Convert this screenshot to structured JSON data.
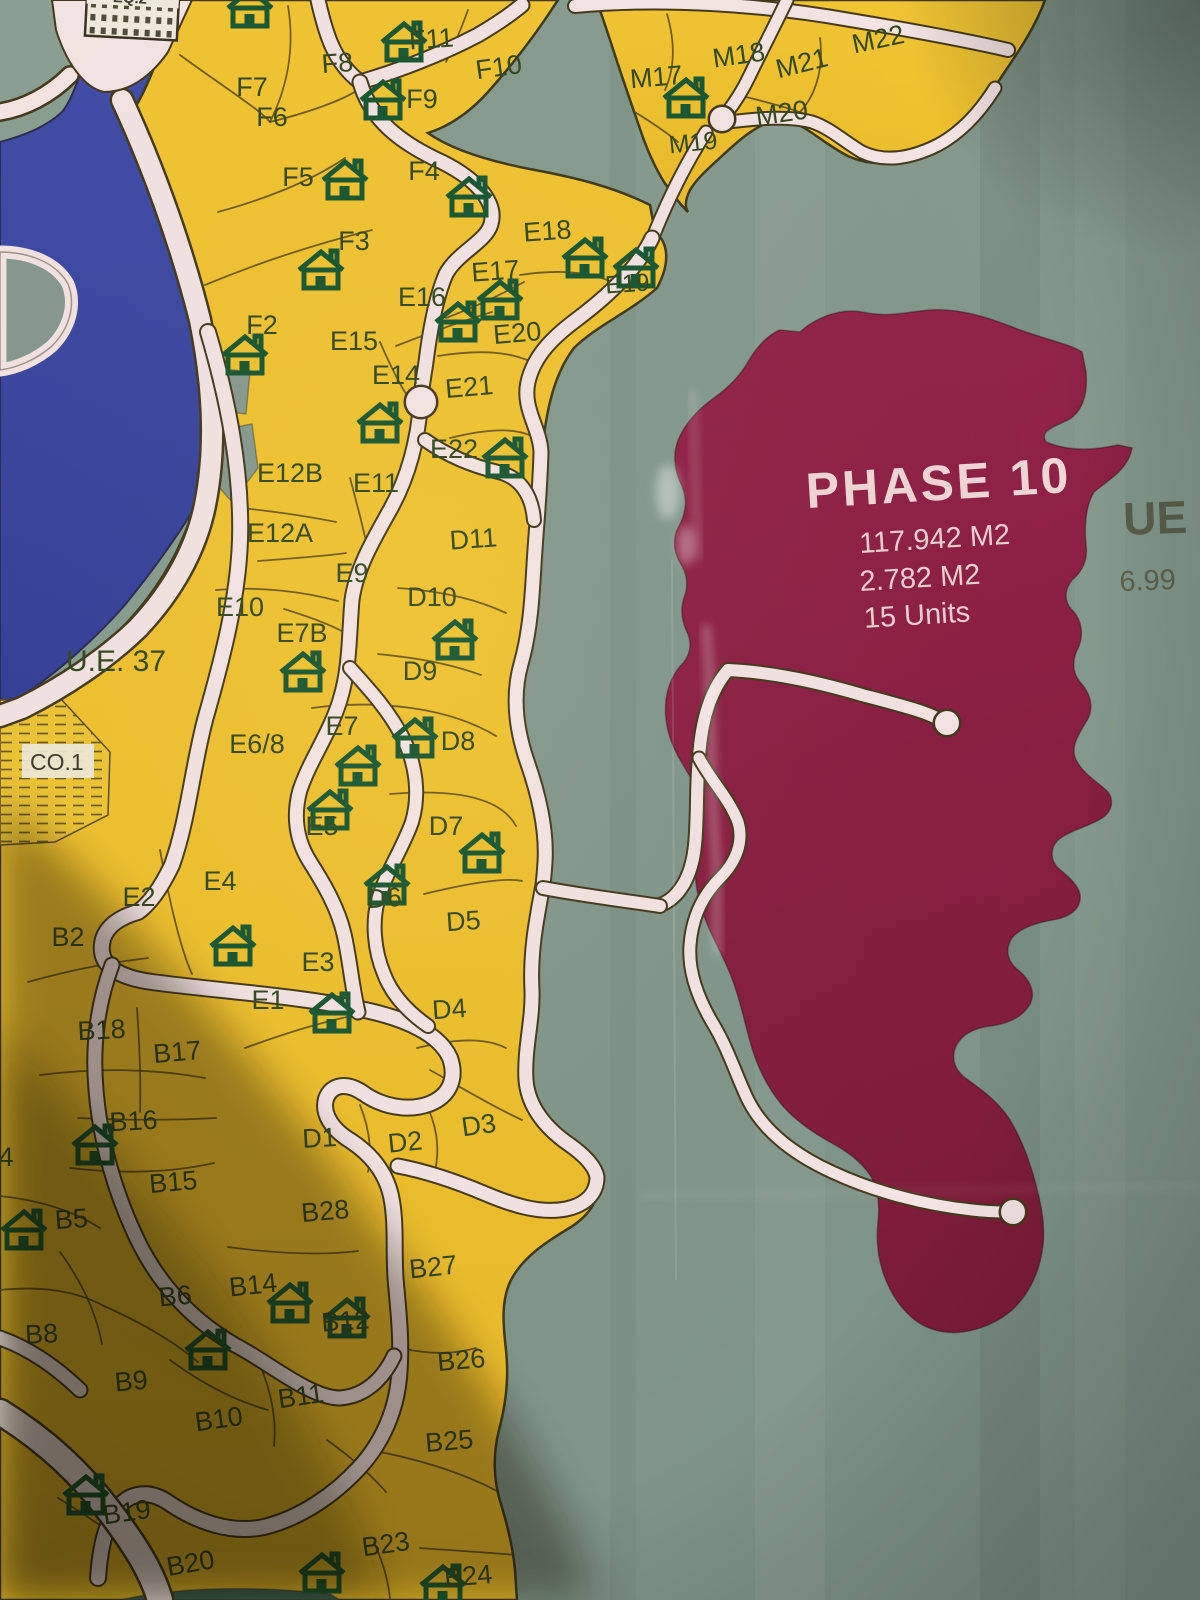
{
  "map": {
    "phase10": {
      "name": "PHASE 10",
      "area1": "117.942 M2",
      "area2": "2.782 M2",
      "units": "15 Units"
    },
    "edge": {
      "ue": "UE",
      "ue_value": "6.99"
    },
    "special": {
      "co1": "CO.1",
      "eq2": "EQ.2"
    },
    "colors": {
      "parcel_yellow": "#efc02e",
      "phase_maroon": "#8c2043",
      "water_blue": "#3c48a0",
      "road_pink": "#f3e3e2",
      "background_teal": "#87998e",
      "label_green": "#33491f",
      "house_green": "#1a5732",
      "phase_text": "#efd5d6"
    },
    "parcels": [
      {
        "id": "F7",
        "x": 252,
        "y": 96
      },
      {
        "id": "F8",
        "x": 338,
        "y": 72,
        "r": -4
      },
      {
        "id": "F11",
        "x": 432,
        "y": 48,
        "r": -4
      },
      {
        "id": "F10",
        "x": 500,
        "y": 76,
        "r": -8
      },
      {
        "id": "M17",
        "x": 657,
        "y": 86,
        "r": -5
      },
      {
        "id": "M18",
        "x": 740,
        "y": 64,
        "r": -8
      },
      {
        "id": "M19",
        "x": 694,
        "y": 151,
        "r": -6,
        "s": 25
      },
      {
        "id": "M20",
        "x": 783,
        "y": 122,
        "r": -8
      },
      {
        "id": "M21",
        "x": 804,
        "y": 72,
        "r": -14
      },
      {
        "id": "M22",
        "x": 880,
        "y": 48,
        "r": -12
      },
      {
        "id": "F6",
        "x": 272,
        "y": 126
      },
      {
        "id": "F9",
        "x": 422,
        "y": 108
      },
      {
        "id": "F5",
        "x": 298,
        "y": 186
      },
      {
        "id": "F4",
        "x": 424,
        "y": 180
      },
      {
        "id": "F3",
        "x": 354,
        "y": 250
      },
      {
        "id": "E18",
        "x": 548,
        "y": 240,
        "r": -4
      },
      {
        "id": "E17",
        "x": 496,
        "y": 280,
        "r": -4
      },
      {
        "id": "E19",
        "x": 628,
        "y": 292,
        "r": -4,
        "s": 25
      },
      {
        "id": "E16",
        "x": 422,
        "y": 306
      },
      {
        "id": "E20",
        "x": 518,
        "y": 342,
        "r": -5
      },
      {
        "id": "F2",
        "x": 262,
        "y": 334
      },
      {
        "id": "E15",
        "x": 354,
        "y": 350
      },
      {
        "id": "E14",
        "x": 396,
        "y": 384
      },
      {
        "id": "E21",
        "x": 470,
        "y": 396,
        "r": -5
      },
      {
        "id": "E22",
        "x": 454,
        "y": 458
      },
      {
        "id": "E12B",
        "x": 290,
        "y": 482
      },
      {
        "id": "E11",
        "x": 376,
        "y": 492
      },
      {
        "id": "D11",
        "x": 474,
        "y": 548,
        "r": -4
      },
      {
        "id": "E12A",
        "x": 280,
        "y": 542
      },
      {
        "id": "E9",
        "x": 352,
        "y": 582
      },
      {
        "id": "D10",
        "x": 432,
        "y": 606
      },
      {
        "id": "E10",
        "x": 240,
        "y": 616
      },
      {
        "id": "E7B",
        "x": 302,
        "y": 642
      },
      {
        "id": "D9",
        "x": 420,
        "y": 680
      },
      {
        "id": "U.E. 37",
        "x": 116,
        "y": 671,
        "s": 30
      },
      {
        "id": "E7",
        "x": 342,
        "y": 735
      },
      {
        "id": "E6/8",
        "x": 257,
        "y": 753
      },
      {
        "id": "D8",
        "x": 458,
        "y": 750
      },
      {
        "id": "E5",
        "x": 322,
        "y": 835
      },
      {
        "id": "D7",
        "x": 446,
        "y": 835
      },
      {
        "id": "E4",
        "x": 220,
        "y": 890
      },
      {
        "id": "E2",
        "x": 139,
        "y": 906
      },
      {
        "id": "D6",
        "x": 385,
        "y": 907,
        "r": -4
      },
      {
        "id": "B2",
        "x": 68,
        "y": 946
      },
      {
        "id": "D5",
        "x": 464,
        "y": 930,
        "r": -4
      },
      {
        "id": "E3",
        "x": 318,
        "y": 971
      },
      {
        "id": "E1",
        "x": 268,
        "y": 1009
      },
      {
        "id": "D4",
        "x": 450,
        "y": 1018,
        "r": -4
      },
      {
        "id": "B18",
        "x": 102,
        "y": 1039,
        "r": -3
      },
      {
        "id": "B17",
        "x": 178,
        "y": 1061,
        "r": -5
      },
      {
        "id": "B16",
        "x": 134,
        "y": 1130,
        "r": -3
      },
      {
        "id": "D1",
        "x": 320,
        "y": 1147,
        "r": -3
      },
      {
        "id": "D2",
        "x": 406,
        "y": 1151,
        "r": -6
      },
      {
        "id": "D3",
        "x": 480,
        "y": 1134,
        "r": -8
      },
      {
        "id": "B15",
        "x": 174,
        "y": 1191,
        "r": -5
      },
      {
        "id": "B5",
        "x": 72,
        "y": 1228,
        "r": -4
      },
      {
        "id": "B28",
        "x": 326,
        "y": 1220,
        "r": -5
      },
      {
        "id": "B14",
        "x": 254,
        "y": 1294,
        "r": -6
      },
      {
        "id": "B27",
        "x": 434,
        "y": 1276,
        "r": -6
      },
      {
        "id": "B6",
        "x": 176,
        "y": 1305,
        "r": -5
      },
      {
        "id": "B12",
        "x": 346,
        "y": 1330,
        "r": -4
      },
      {
        "id": "B8",
        "x": 42,
        "y": 1343,
        "r": -3
      },
      {
        "id": "B26",
        "x": 462,
        "y": 1369,
        "r": -5
      },
      {
        "id": "B9",
        "x": 132,
        "y": 1390,
        "r": -5
      },
      {
        "id": "B11",
        "x": 302,
        "y": 1405,
        "r": -8
      },
      {
        "id": "B10",
        "x": 220,
        "y": 1428,
        "r": -8
      },
      {
        "id": "B25",
        "x": 450,
        "y": 1450,
        "r": -5
      },
      {
        "id": "B19",
        "x": 128,
        "y": 1521,
        "r": -8
      },
      {
        "id": "B20",
        "x": 192,
        "y": 1572,
        "r": -10
      },
      {
        "id": "B23",
        "x": 387,
        "y": 1553,
        "r": -8
      },
      {
        "id": "B24",
        "x": 469,
        "y": 1585,
        "r": -5
      },
      {
        "id": "4",
        "x": 6,
        "y": 1166
      }
    ],
    "houses": [
      [
        250,
        8
      ],
      [
        404,
        42
      ],
      [
        686,
        98
      ],
      [
        383,
        100
      ],
      [
        345,
        180
      ],
      [
        469,
        197
      ],
      [
        321,
        270
      ],
      [
        585,
        258
      ],
      [
        636,
        268
      ],
      [
        500,
        300
      ],
      [
        458,
        322
      ],
      [
        245,
        355
      ],
      [
        380,
        423
      ],
      [
        505,
        458
      ],
      [
        455,
        640
      ],
      [
        303,
        672
      ],
      [
        415,
        738
      ],
      [
        358,
        766
      ],
      [
        330,
        810
      ],
      [
        482,
        853
      ],
      [
        387,
        885
      ],
      [
        233,
        946
      ],
      [
        332,
        1013
      ],
      [
        95,
        1145
      ],
      [
        24,
        1230
      ],
      [
        290,
        1303
      ],
      [
        347,
        1318
      ],
      [
        208,
        1350
      ],
      [
        86,
        1495
      ],
      [
        322,
        1573
      ],
      [
        443,
        1585
      ]
    ]
  }
}
